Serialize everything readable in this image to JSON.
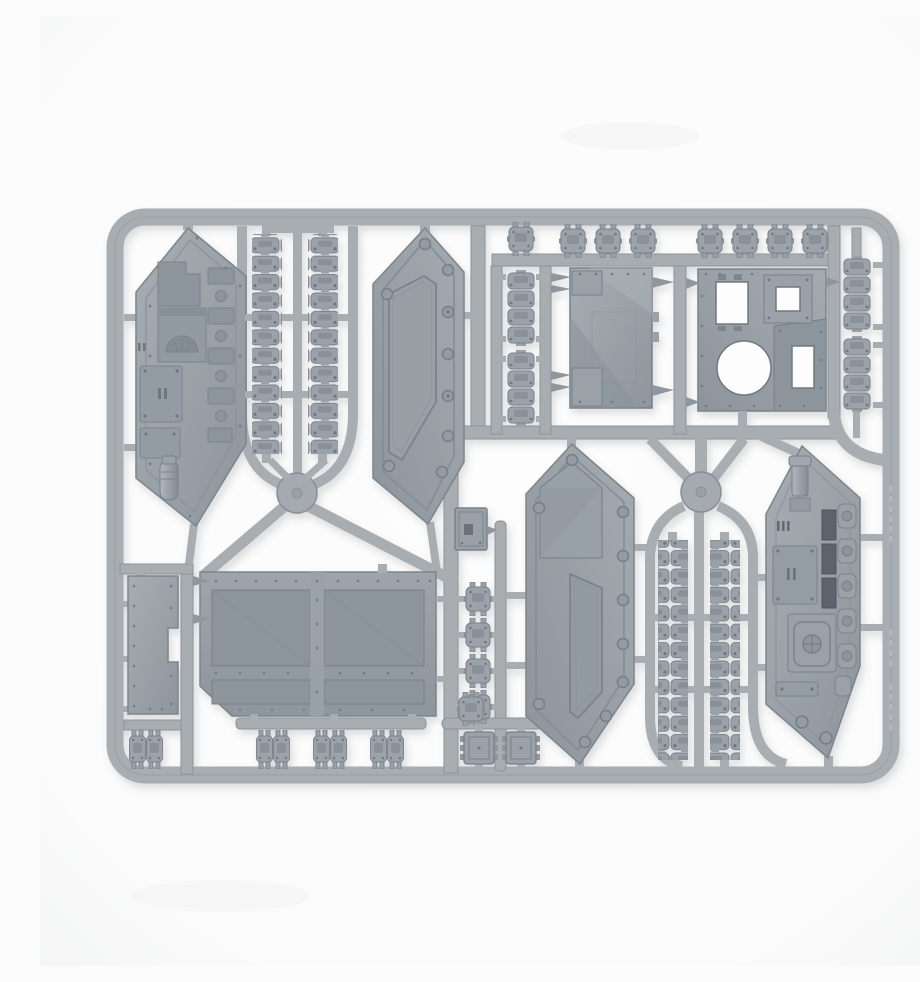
{
  "meta": {
    "description": "Product photo of a light grey polystyrene model kit sprue for a tracked tank vehicle, photographed on a plain white background",
    "image_type": "product-photo",
    "subject": "plastic-model-sprue"
  },
  "palette": {
    "background": "#fcfcfc",
    "sprue_base": "#a6acb1",
    "sprue_edge": "#8d9399",
    "panel_face_light": "#a3aab0",
    "panel_face_dark": "#8f979e",
    "recess": "#8a9299",
    "slot_dark": "#5d646d",
    "rivet": "#6f7780",
    "hole_white": "#fdfdfd",
    "highlight": "#b6bbbf"
  },
  "sprue": {
    "frame": "rounded rectangular runner frame with two circular junction bosses",
    "junction_boss_count": 2,
    "embossed_ridge": "illegible moulded maker text along right rail",
    "parts": [
      {
        "name": "hull side armour panel (exterior door face)",
        "count": 2
      },
      {
        "name": "hull side panel (interior detail face)",
        "count": 2
      },
      {
        "name": "assault ramp door with recessed panels",
        "count": 1
      },
      {
        "name": "narrow hull side plate",
        "count": 1
      },
      {
        "name": "hull box section with circular mount hole",
        "count": 1
      },
      {
        "name": "engine access hatch panel",
        "count": 1
      },
      {
        "name": "small access door",
        "count": 1
      },
      {
        "name": "long track run",
        "count": 4
      },
      {
        "name": "four-link track section",
        "count": 4
      },
      {
        "name": "single track link",
        "count": 21
      },
      {
        "name": "small hatch box",
        "count": 2
      }
    ]
  }
}
